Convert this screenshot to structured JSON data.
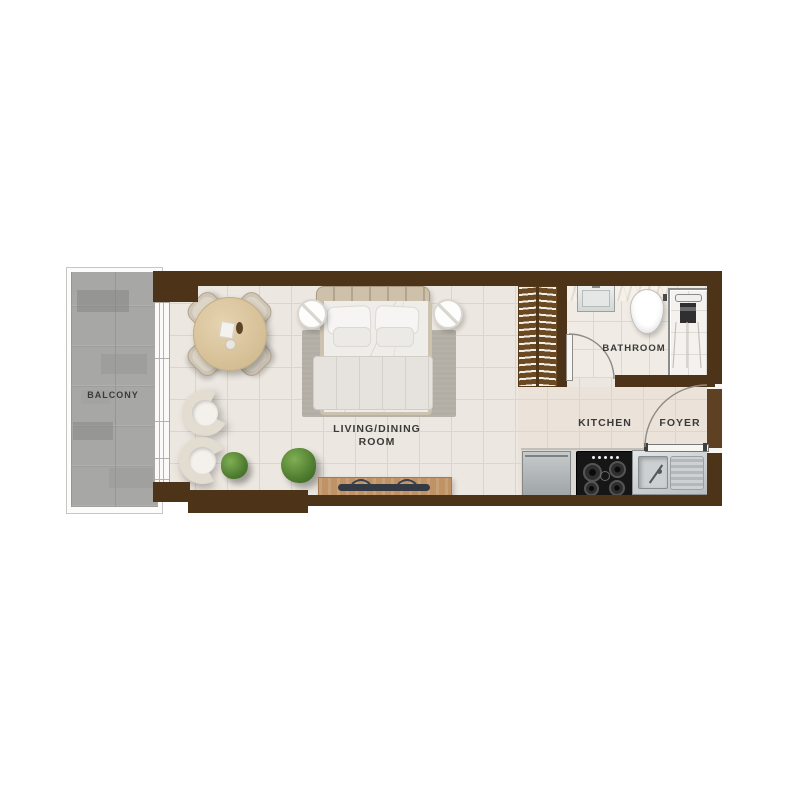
{
  "rooms": {
    "balcony": {
      "label": "BALCONY"
    },
    "living_dining": {
      "label_line1": "LIVING/DINING",
      "label_line2": "ROOM"
    },
    "bathroom": {
      "label": "BATHROOM"
    },
    "kitchen": {
      "label": "KITCHEN"
    },
    "foyer": {
      "label": "FOYER"
    }
  },
  "colors": {
    "wall_brown": "#4d3317",
    "floor_tile": "#ece7e0",
    "tile_grout": "#dcd5cc",
    "balcony_concrete": "#a7a7a5",
    "wardrobe_wood": "#6b4a23",
    "console_wood": "#bf9366",
    "table_wood": "#dbc6a0",
    "plant_green": "#4e7c30",
    "stove_black": "#161616",
    "steel_gray": "#c3c7c9",
    "label_text": "#3a3a3a"
  }
}
